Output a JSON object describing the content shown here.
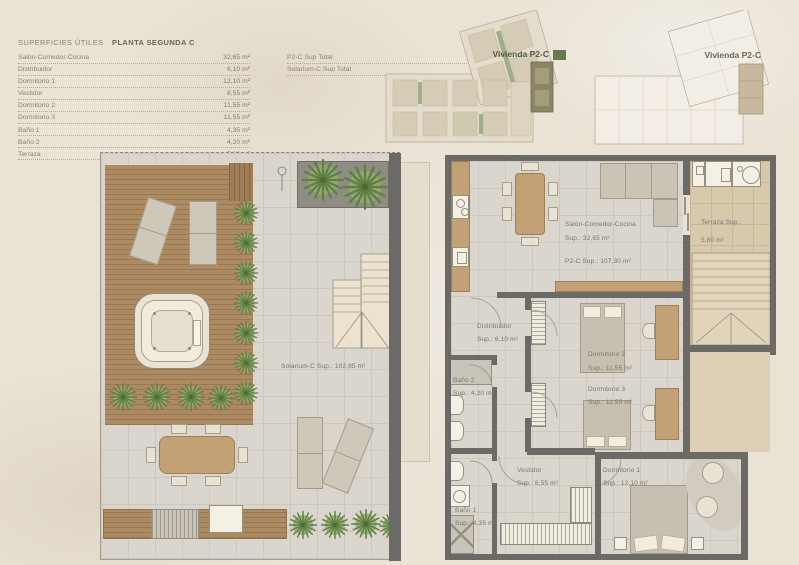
{
  "header": {
    "title": "SUPERFICIES ÚTILES",
    "subtitle": "PLANTA SEGUNDA C",
    "rows": [
      {
        "label": "Salón-Comedor-Cocina",
        "value": "32,65 m²"
      },
      {
        "label": "Distribuidor",
        "value": "6,10 m²"
      },
      {
        "label": "Dormitorio 1",
        "value": "12,10 m²"
      },
      {
        "label": "Vestidor",
        "value": "8,55 m²"
      },
      {
        "label": "Dormitorio 2",
        "value": "11,55 m²"
      },
      {
        "label": "Dormitorio 3",
        "value": "11,55 m²"
      },
      {
        "label": "Baño 1",
        "value": "4,35 m²"
      },
      {
        "label": "Baño 2",
        "value": "4,20 m²"
      },
      {
        "label": "Terraza",
        "value": "5,80 m²"
      }
    ],
    "totals": [
      {
        "label": "P2-C Sup Total",
        "value": "107,30 m²"
      },
      {
        "label": "Solarium-C Sup Total",
        "value": "102,85 m²"
      }
    ]
  },
  "key_plans": {
    "rendered_label": "Vivienda P2-C",
    "line_label": "Vivienda P2-C"
  },
  "solarium": {
    "area_label": "Solarium-C Sup.: 102,85 m²"
  },
  "apartment": {
    "salon_name": "Salón-Comedor-Cocina",
    "salon_sup": "Sup.: 32,65 m²",
    "salon_total": "P2-C Sup.: 107,30 m²",
    "terraza_name": "Terraza Sup.:",
    "terraza_sup": "5,80 m²",
    "distribuidor_name": "Distribuidor",
    "distribuidor_sup": "Sup.: 6,10 m²",
    "dorm2_name": "Dormitorio 2",
    "dorm2_sup": "Sup.: 11,55 m²",
    "dorm3_name": "Dormitorio 3",
    "dorm3_sup": "Sup.: 11,55 m²",
    "bano2_name": "Baño 2",
    "bano2_sup": "Sup.: 4,20 m²",
    "vestidor_name": "Vestidor",
    "vestidor_sup": "Sup.: 8,55 m²",
    "bano1_name": "Baño 1",
    "bano1_sup": "Sup.: 4,35 m²",
    "dorm1_name": "Dormitorio 1",
    "dorm1_sup": "Sup.: 12,10 m²"
  },
  "colors": {
    "sheet_background": "#e9e2d5",
    "wall": "#6b6a66",
    "tile_floor": "#dad6ce",
    "terrace_floor": "#d8c9ad",
    "deck_wood": "#ac8a62",
    "furniture_wood": "#c2a176",
    "plant_green": "#93ad6b",
    "highlight_unit": "#8a8566",
    "label_text": "#7b7468"
  }
}
